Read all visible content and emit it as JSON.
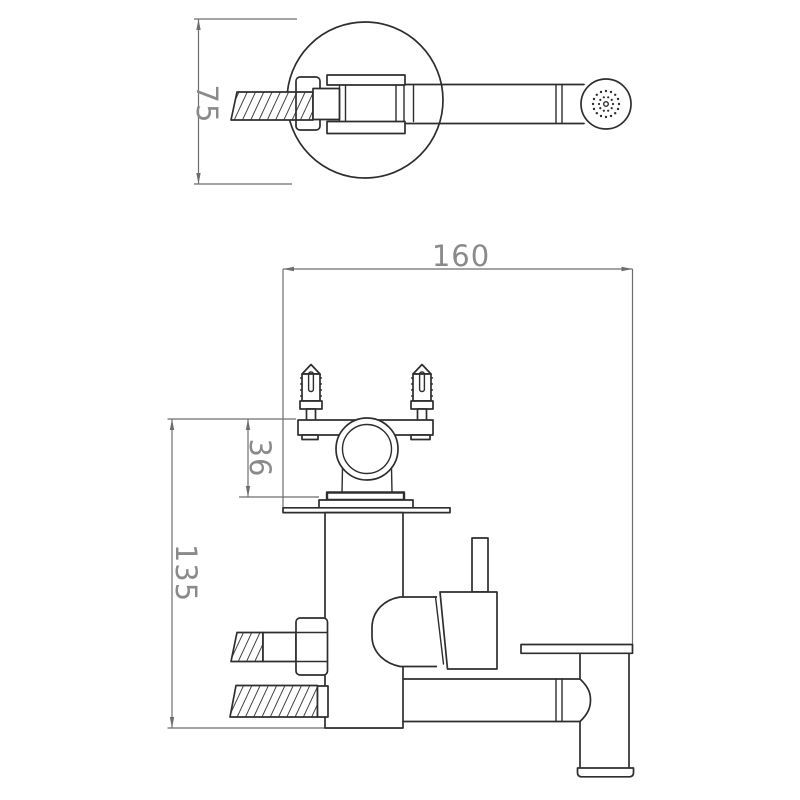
{
  "drawing": {
    "kind": "technical-dimension-drawing",
    "background": "#ffffff",
    "colors": {
      "line": "#2e2e2e",
      "dim_line": "#6e6e6e",
      "dim_text": "#8a8a8a"
    },
    "views": {
      "detail_top": {
        "description": "hand sprayer with hose detail view",
        "dims": {
          "hose_height": "75"
        }
      },
      "front": {
        "description": "faucet front view",
        "dims": {
          "overall_width": "160",
          "valve_offset": "36",
          "body_height": "135"
        }
      }
    }
  }
}
